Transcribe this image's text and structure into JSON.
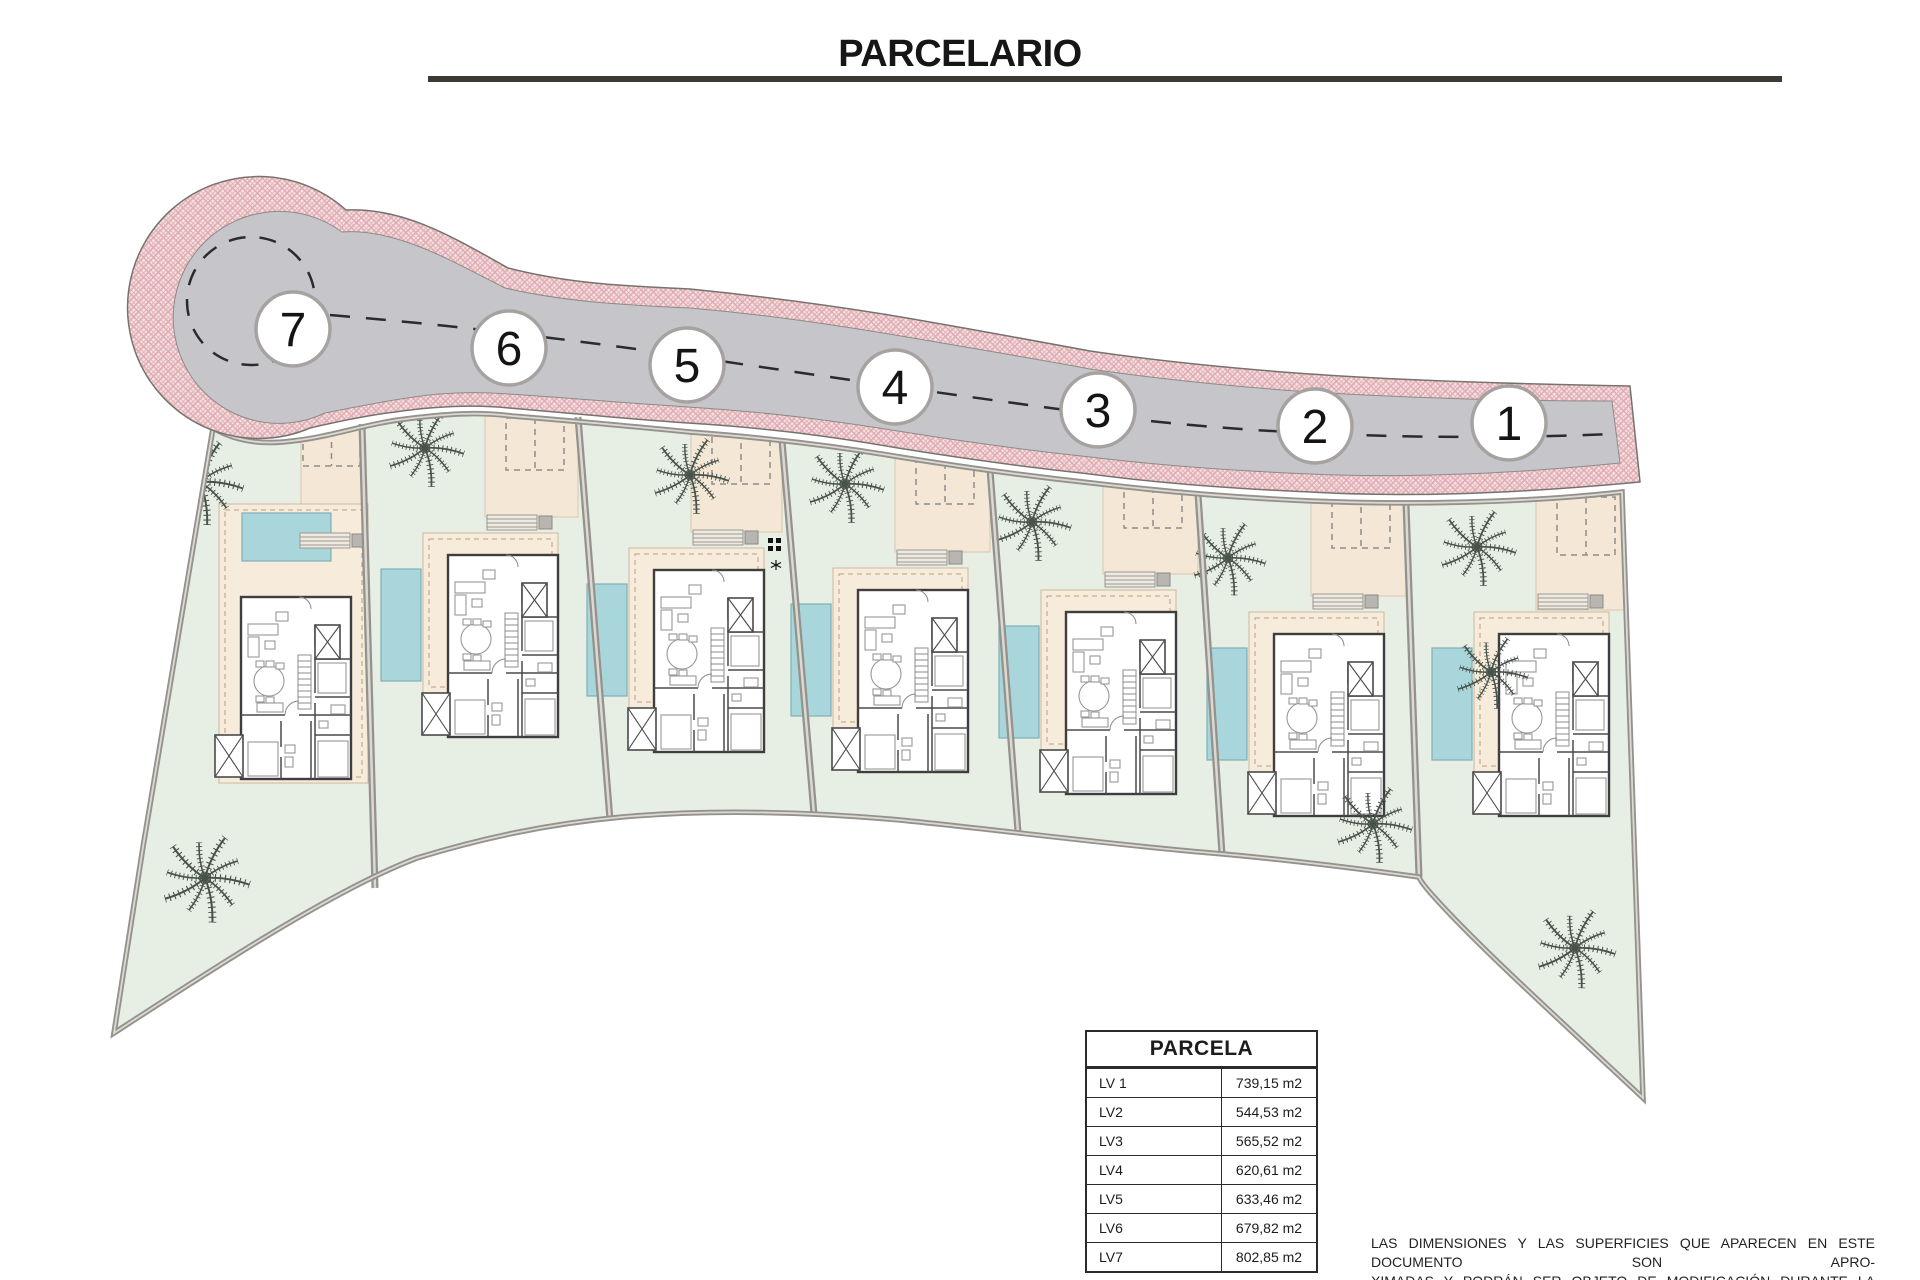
{
  "title": {
    "text": "PARCELARIO"
  },
  "plan": {
    "name": "site-plan-parcelario",
    "lots": [
      {
        "number": "7"
      },
      {
        "number": "6"
      },
      {
        "number": "5"
      },
      {
        "number": "4"
      },
      {
        "number": "3"
      },
      {
        "number": "2"
      },
      {
        "number": "1"
      }
    ]
  },
  "table": {
    "header": "PARCELA",
    "rows": [
      {
        "label": "LV 1",
        "value": "739,15 m2"
      },
      {
        "label": "LV2",
        "value": "544,53 m2"
      },
      {
        "label": "LV3",
        "value": "565,52 m2"
      },
      {
        "label": "LV4",
        "value": "620,61 m2"
      },
      {
        "label": "LV5",
        "value": "633,46 m2"
      },
      {
        "label": "LV6",
        "value": "679,82 m2"
      },
      {
        "label": "LV7",
        "value": "802,85 m2"
      }
    ]
  },
  "disclaimer": {
    "lines": [
      "LAS DIMENSIONES Y LAS SUPERFICIES QUE APARECEN EN ESTE DOCUMENTO SON APRO-",
      "XIMADAS Y PODRÁN SER OBJETO DE MODIFICACIÓN DURANTE LA REDACCIÓN DE LOS",
      "PROYECTOS BÁSICO Y DE EJECUCIÓN."
    ]
  },
  "colors": {
    "road_asphalt": "#c6c5ca",
    "road_border_pink": "#e0aab0",
    "lawn": "#e7eee3",
    "terrace_beige": "#f7ecdc",
    "pool_blue": "#a9d6db",
    "boundary_gray": "#94928d"
  }
}
